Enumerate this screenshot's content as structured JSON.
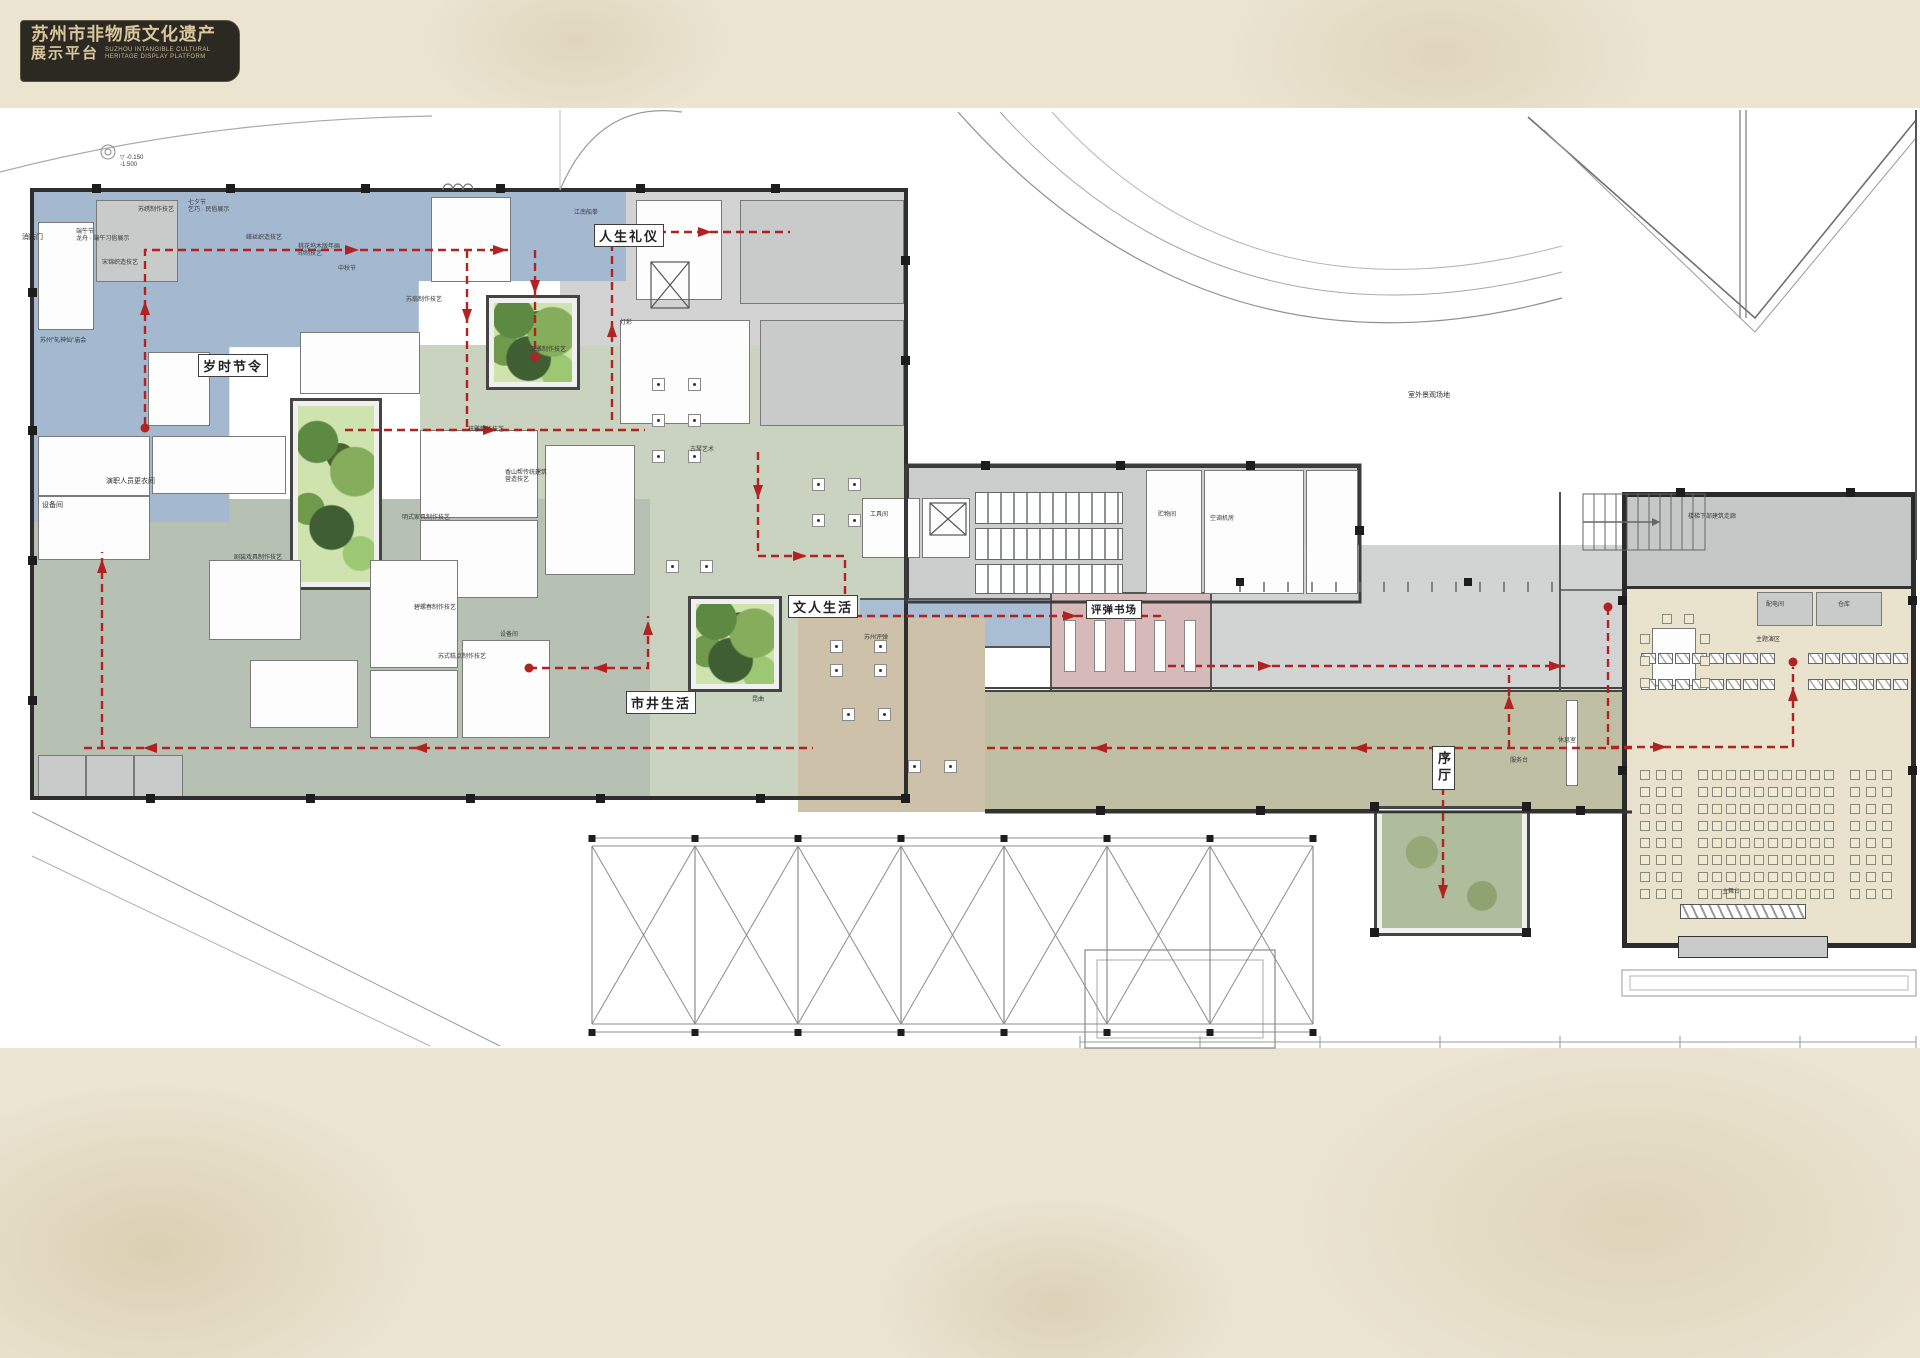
{
  "logo": {
    "title_cn": "苏州市非物质文化遗产",
    "subtitle_cn": "展示平台",
    "subtitle_en1": "SUZHOU INTANGIBLE CULTURAL",
    "subtitle_en2": "HERITAGE DISPLAY PLATFORM"
  },
  "colors": {
    "parchment": "#ebe4d1",
    "sheet": "#ffffff",
    "zone_blue": "#a4b9d0",
    "zone_sage": "#b7c1b3",
    "zone_green": "#c9d3bf",
    "zone_grey": "#d2d3d2",
    "zone_olive": "#bfbfa3",
    "zone_tan": "#cdc1a9",
    "zone_pink": "#d6b9b9",
    "zone_cream": "#e9e3ce",
    "route_red": "#b02320",
    "wall": "#2e2e2e",
    "courtyard_green": "#5d8a43",
    "logo_bg": "#2c2822",
    "logo_text": "#d8c79c"
  },
  "zone_labels": [
    {
      "t": "岁时节令",
      "x": 198,
      "y": 354,
      "cls": "zbox"
    },
    {
      "t": "人生礼仪",
      "x": 594,
      "y": 224,
      "cls": "zbox"
    },
    {
      "t": "市井生活",
      "x": 626,
      "y": 691,
      "cls": "zbox"
    },
    {
      "t": "文人生活",
      "x": 788,
      "y": 595,
      "cls": "zbox"
    },
    {
      "t": "评弹书场",
      "x": 1086,
      "y": 600,
      "cls": "zbox zbox-sm"
    },
    {
      "t": "序厅",
      "x": 1432,
      "y": 746,
      "cls": "zbox zbox-v"
    }
  ],
  "labels": [
    {
      "t": "消防门",
      "x": 22,
      "y": 234,
      "cls": "lbl"
    },
    {
      "t": "端午节\n龙舟 · 端午习俗展示",
      "x": 76,
      "y": 229,
      "cls": "lbl2"
    },
    {
      "t": "七夕节\n乞巧 · 民俗展示",
      "x": 188,
      "y": 200,
      "cls": "lbl2"
    },
    {
      "t": "江南船拳",
      "x": 574,
      "y": 210,
      "cls": "lbl2"
    },
    {
      "t": "中秋节",
      "x": 338,
      "y": 266,
      "cls": "lbl2"
    },
    {
      "t": "苏州\"轧神仙\"庙会",
      "x": 40,
      "y": 338,
      "cls": "lbl2"
    },
    {
      "t": "设备间",
      "x": 42,
      "y": 502,
      "cls": "lbl"
    },
    {
      "t": "演职人员更衣间",
      "x": 106,
      "y": 478,
      "cls": "lbl"
    },
    {
      "t": "设备间",
      "x": 500,
      "y": 632,
      "cls": "lbl2"
    },
    {
      "t": "工具间",
      "x": 870,
      "y": 512,
      "cls": "lbl2"
    },
    {
      "t": "贮物间",
      "x": 1158,
      "y": 512,
      "cls": "lbl2"
    },
    {
      "t": "空调机房",
      "x": 1210,
      "y": 516,
      "cls": "lbl2"
    },
    {
      "t": "配电间",
      "x": 1766,
      "y": 602,
      "cls": "lbl2"
    },
    {
      "t": "仓库",
      "x": 1838,
      "y": 602,
      "cls": "lbl2"
    },
    {
      "t": "服务台",
      "x": 1510,
      "y": 758,
      "cls": "lbl2"
    },
    {
      "t": "主题演区",
      "x": 1756,
      "y": 637,
      "cls": "lbl2"
    },
    {
      "t": "主舞台",
      "x": 1722,
      "y": 889,
      "cls": "lbl2"
    },
    {
      "t": "室外景观场地",
      "x": 1408,
      "y": 392,
      "cls": "lbl"
    },
    {
      "t": "楼梯下部建筑走廊",
      "x": 1688,
      "y": 514,
      "cls": "lbl2"
    },
    {
      "t": "休息室",
      "x": 1558,
      "y": 738,
      "cls": "lbl2"
    },
    {
      "t": "灯彩",
      "x": 620,
      "y": 320,
      "cls": "lbl2"
    },
    {
      "t": "苏绣制作技艺",
      "x": 138,
      "y": 207,
      "cls": "lbl2"
    },
    {
      "t": "宋锦织造技艺",
      "x": 102,
      "y": 260,
      "cls": "lbl2"
    },
    {
      "t": "缂丝织造技艺",
      "x": 246,
      "y": 235,
      "cls": "lbl2"
    },
    {
      "t": "桃花坞木版年画\n印制技艺",
      "x": 298,
      "y": 244,
      "cls": "lbl2"
    },
    {
      "t": "苏扇制作技艺",
      "x": 406,
      "y": 297,
      "cls": "lbl2"
    },
    {
      "t": "玉雕制作技艺",
      "x": 530,
      "y": 347,
      "cls": "lbl2"
    },
    {
      "t": "核雕制作技艺",
      "x": 468,
      "y": 427,
      "cls": "lbl2"
    },
    {
      "t": "明式家具制作技艺",
      "x": 402,
      "y": 515,
      "cls": "lbl2"
    },
    {
      "t": "香山帮传统建筑\n营造技艺",
      "x": 505,
      "y": 470,
      "cls": "lbl2"
    },
    {
      "t": "碧螺春制作技艺",
      "x": 414,
      "y": 605,
      "cls": "lbl2"
    },
    {
      "t": "苏式糕点制作技艺",
      "x": 438,
      "y": 654,
      "cls": "lbl2"
    },
    {
      "t": "剧装戏具制作技艺",
      "x": 234,
      "y": 555,
      "cls": "lbl2"
    },
    {
      "t": "古琴艺术",
      "x": 690,
      "y": 447,
      "cls": "lbl2"
    },
    {
      "t": "昆曲",
      "x": 752,
      "y": 697,
      "cls": "lbl2"
    },
    {
      "t": "苏州评弹",
      "x": 864,
      "y": 635,
      "cls": "lbl2"
    },
    {
      "t": "▽ -0.150\n    -1.500",
      "x": 120,
      "y": 155,
      "cls": "lbl2"
    }
  ]
}
